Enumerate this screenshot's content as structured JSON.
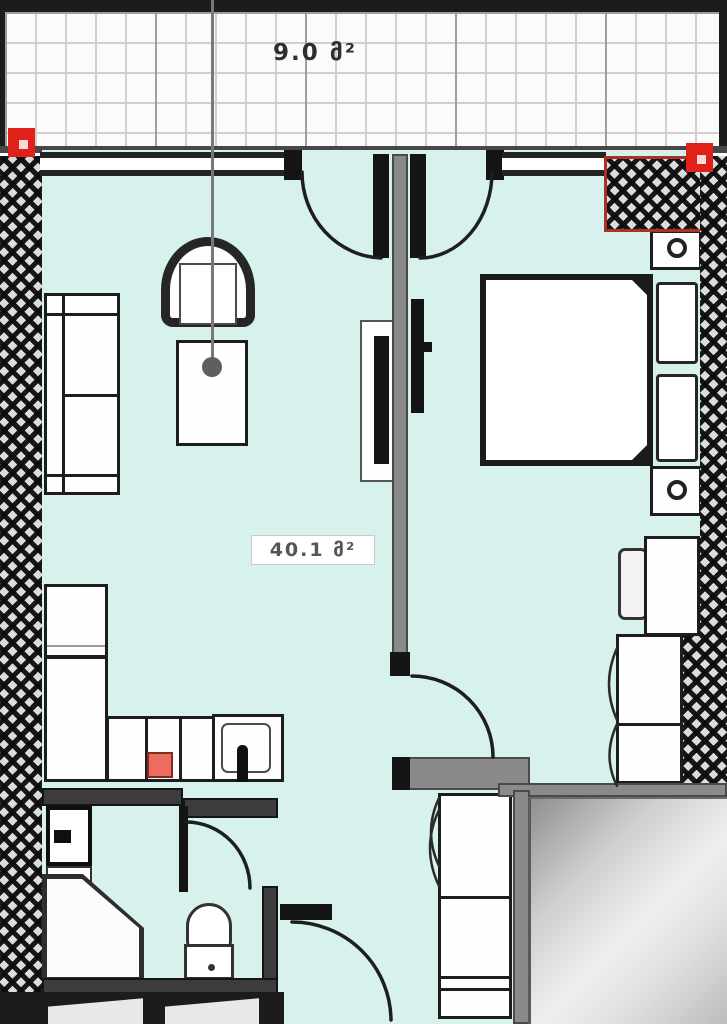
{
  "labels": {
    "balcony_area": "9.0 მ²",
    "apartment_area": "40.1 მ²"
  },
  "colors": {
    "floor": "#d7f2ec",
    "wall_dark": "#1e1e1e",
    "wall_gray": "#8a8a8a",
    "marker_red": "#e0211a",
    "outline_red": "#a83226",
    "stove_red": "#ee6b5f",
    "balcony_grid": "#cfcfcf"
  },
  "furniture_icons": [
    "sofa",
    "armchair",
    "side-table",
    "tv",
    "bed",
    "pillow",
    "nightstand-lamp",
    "desk",
    "desk-chair",
    "wardrobe",
    "kitchen-counter",
    "stove",
    "sink-faucet",
    "refrigerator",
    "washing-machine",
    "vanity",
    "toilet",
    "door-swing-arc",
    "dimension-line",
    "red-corner-marker"
  ]
}
